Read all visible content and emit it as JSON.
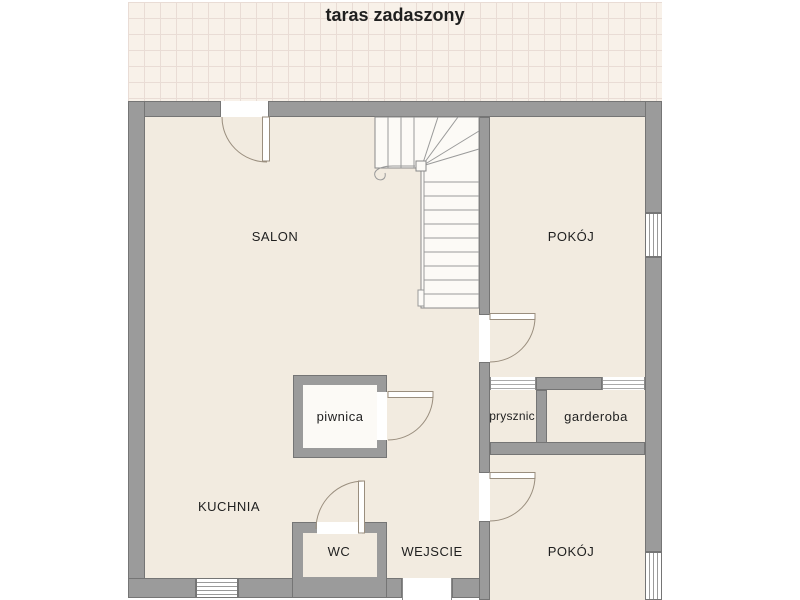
{
  "plan": {
    "terrace_label": "taras zadaszony",
    "rooms": {
      "salon": "SALON",
      "pokoj_top": "POKÓJ",
      "kuchnia": "KUCHNIA",
      "wejscie": "WEJSCIE",
      "wc": "WC",
      "pokoj_bottom": "POKÓJ",
      "piwnica": "piwnica",
      "prysznic": "prysznic",
      "garderoba": "garderoba"
    },
    "colors": {
      "background": "#ffffff",
      "terrace_bg": "#f8f1e9",
      "terrace_grid": "#e9dcd5",
      "floor": "#f2ebe0",
      "wall": "#9b9b9b",
      "wall_outline": "#757575",
      "stairs_fill": "#fcfaf6",
      "door_line": "#9a8e7e",
      "text": "#1f1f1f"
    }
  }
}
